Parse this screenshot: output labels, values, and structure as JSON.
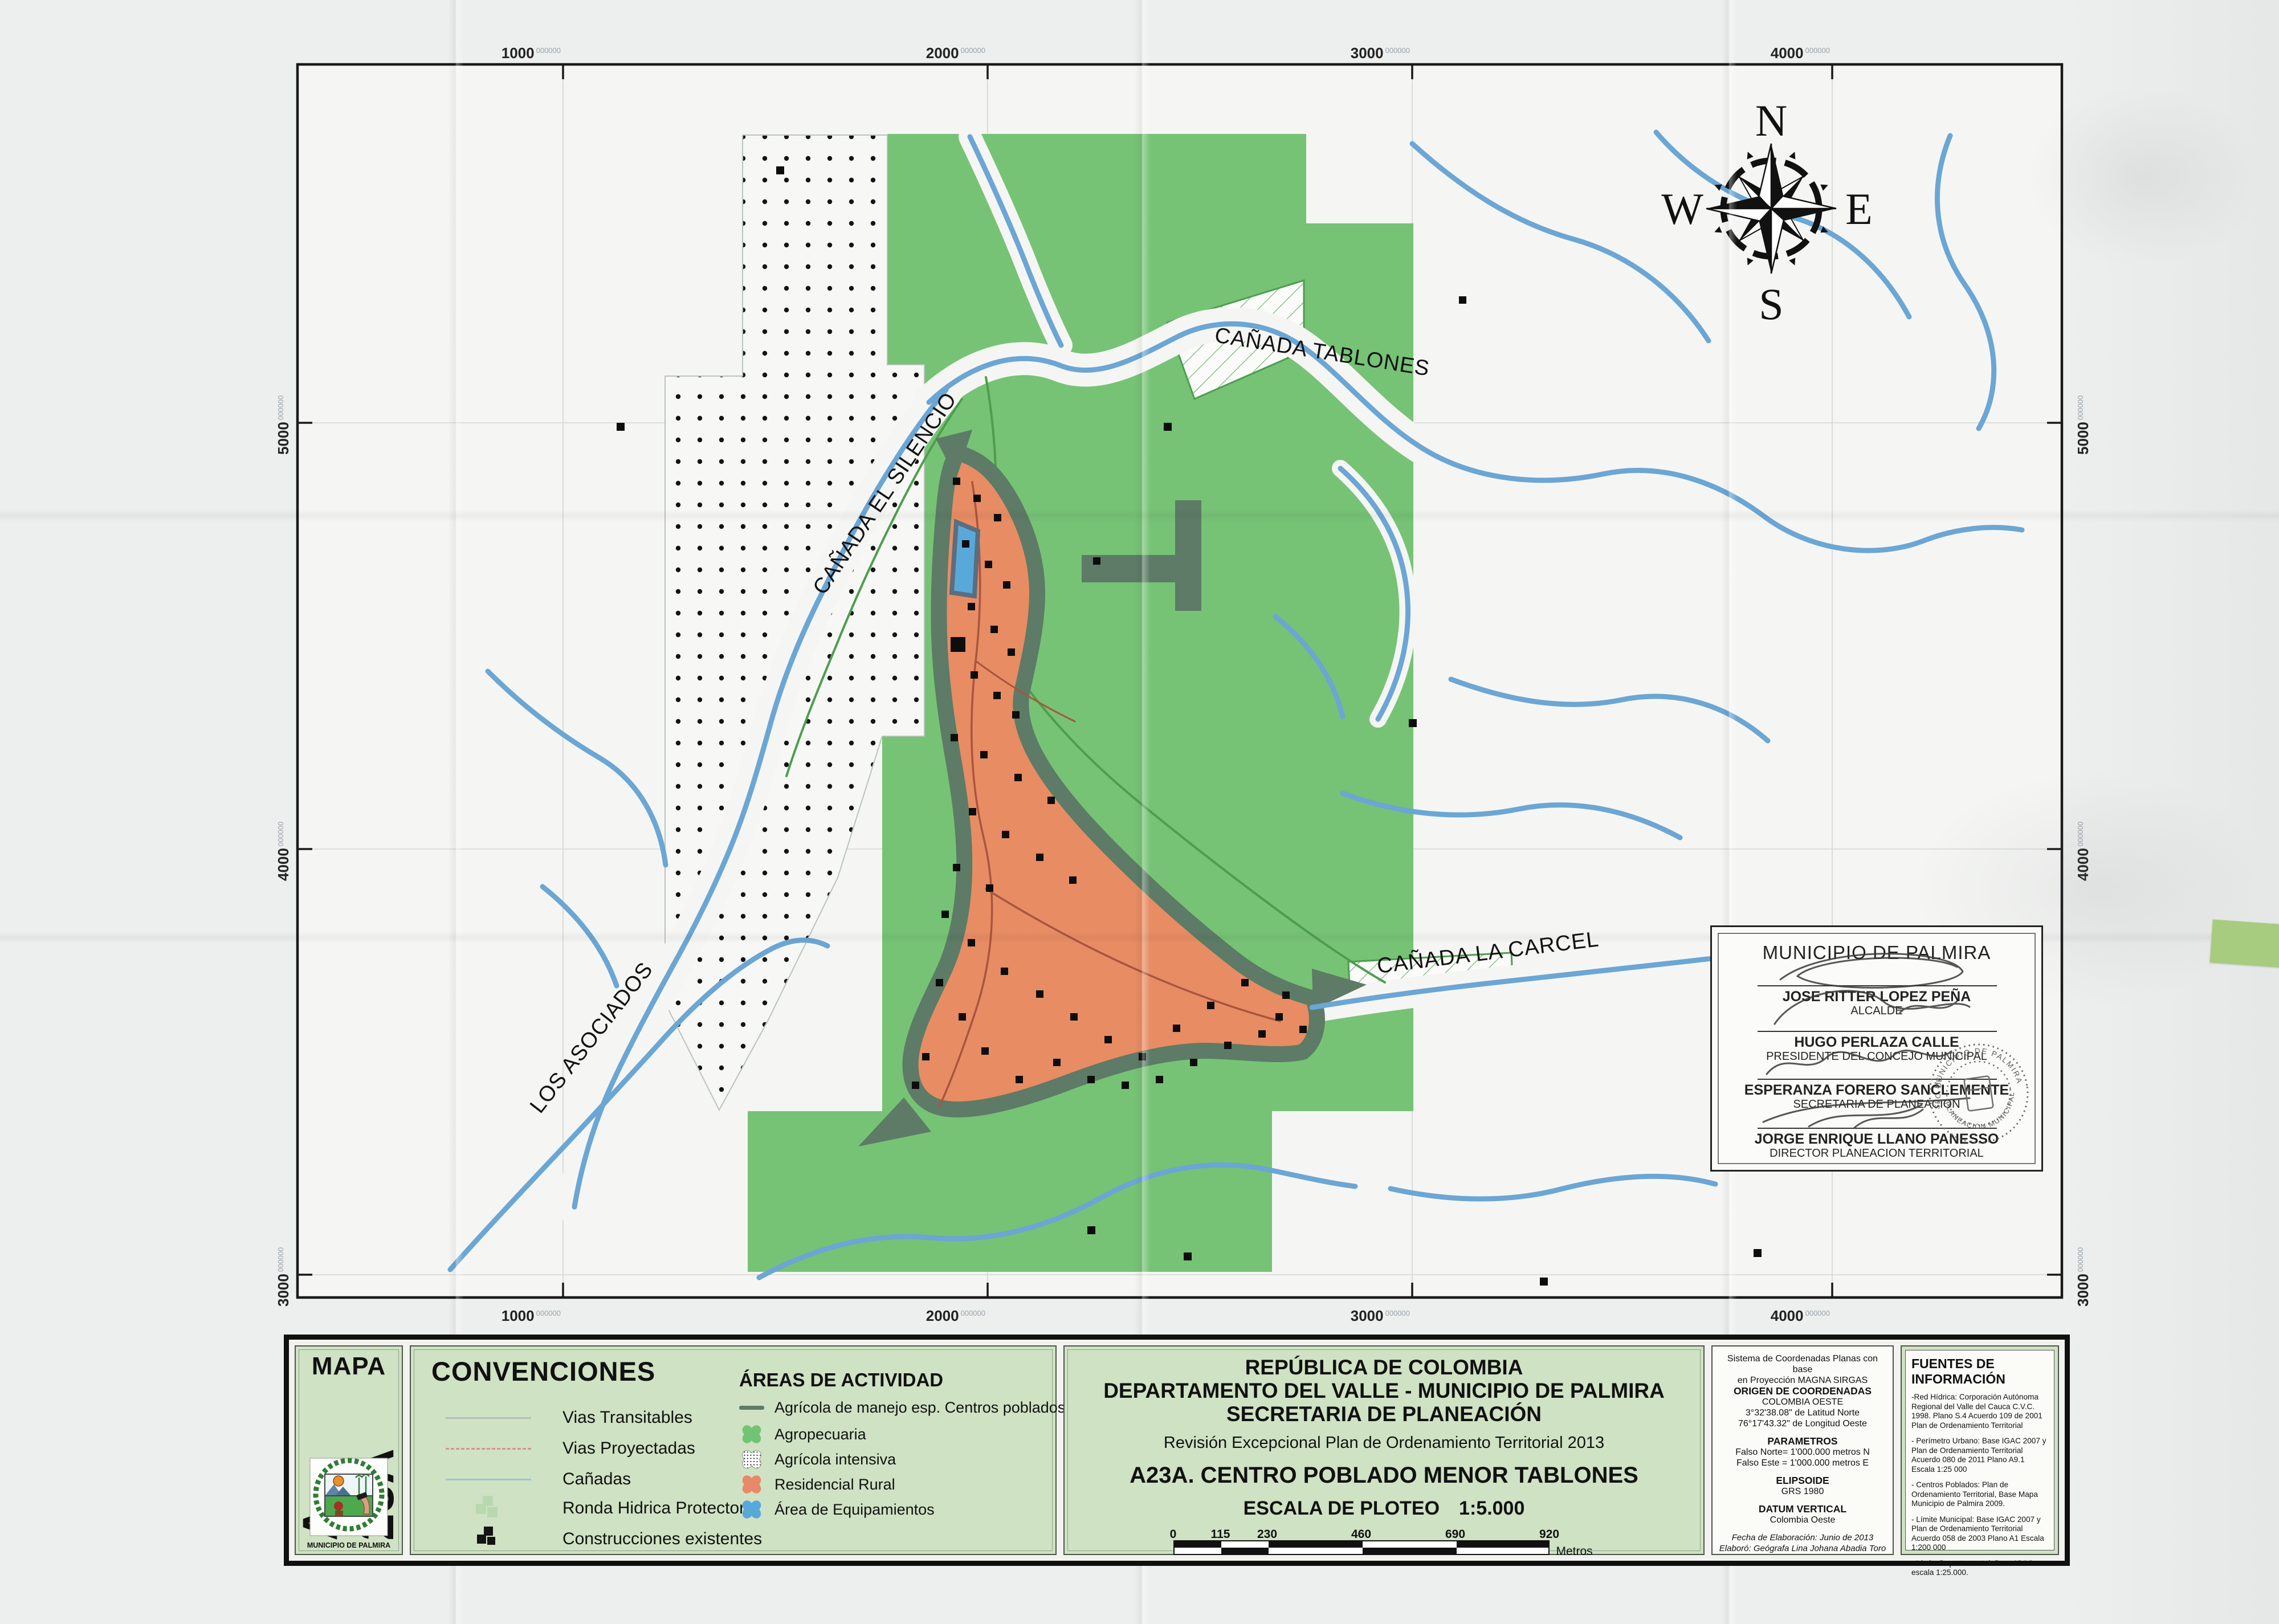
{
  "colors": {
    "paper": "#edefee",
    "map_background": "#f5f6f4",
    "agropecuaria_green": "#76c375",
    "residencial_orange": "#e88c63",
    "ronda_band_sage": "#5d7b66",
    "equipamientos_blue": "#58a9da",
    "river_blue": "#6ba6d4",
    "legend_green": "#cfe2c3",
    "sticky_tab_green": "#a7cc7f",
    "vias_proyectadas_red": "#d99090",
    "vias_transitables_gray": "#b8bdb8"
  },
  "map": {
    "grid": {
      "sup": "000000",
      "top": [
        "1000",
        "2000",
        "3000",
        "4000"
      ],
      "bottom": [
        "1000",
        "2000",
        "3000",
        "4000"
      ],
      "left": [
        "5000",
        "4000",
        "3000"
      ],
      "right": [
        "5000",
        "4000",
        "3000"
      ]
    },
    "labels": {
      "tablones": "CAÑADA TABLONES",
      "silencio": "CAÑADA EL SILENCIO",
      "carcel": "CAÑADA LA CARCEL",
      "asociados": "LOS ASOCIADOS"
    },
    "compass": {
      "n": "N",
      "e": "E",
      "s": "S",
      "w": "W"
    }
  },
  "sig": {
    "title": "MUNICIPIO DE PALMIRA",
    "s1name": "JOSE RITTER LOPEZ PEÑA",
    "s1role": "ALCALDE",
    "s2name": "HUGO PERLAZA CALLE",
    "s2role": "PRESIDENTE DEL CONCEJO MUNICIPAL",
    "s3name": "ESPERANZA FORERO SANCLEMENTE",
    "s3role": "SECRETARIA DE PLANEACION",
    "s4name": "JORGE ENRIQUE LLANO PANESSO",
    "s4role": "DIRECTOR PLANEACION TERRITORIAL",
    "stamp_top": "MUNICIPIO DE PALMIRA",
    "stamp_bottom": "PLANEACION MUNICIPAL",
    "stamp_left": "SEC. DE"
  },
  "panel": {
    "mapa": {
      "word": "MAPA",
      "code": "A-23A",
      "caption": "MUNICIPIO DE PALMIRA"
    },
    "conv": {
      "title": "CONVENCIONES",
      "items": [
        {
          "label": "Vias Transitables"
        },
        {
          "label": "Vias Proyectadas"
        },
        {
          "label": "Cañadas"
        },
        {
          "label": "Ronda Hidrica Protectora"
        },
        {
          "label": "Construcciones existentes"
        }
      ]
    },
    "areas": {
      "title": "ÁREAS DE ACTIVIDAD",
      "items": [
        {
          "label": "Agrícola de manejo esp. Centros poblados"
        },
        {
          "label": "Agropecuaria"
        },
        {
          "label": "Agrícola intensiva"
        },
        {
          "label": "Residencial Rural"
        },
        {
          "label": "Área de Equipamientos"
        }
      ]
    },
    "tb": {
      "l1": "REPÚBLICA DE COLOMBIA",
      "l2": "DEPARTAMENTO DEL VALLE - MUNICIPIO DE PALMIRA",
      "l3": "SECRETARIA DE PLANEACIÓN",
      "sub": "Revisión Excepcional Plan de Ordenamiento Territorial 2013",
      "map_title": "A23A. CENTRO POBLADO MENOR TABLONES",
      "scale_label": "ESCALA DE PLOTEO",
      "scale_value": "1:5.000",
      "ticks": [
        "0",
        "115",
        "230",
        "460",
        "690",
        "920"
      ],
      "unit": "Metros"
    },
    "coords": {
      "c1": "Sistema de Coordenadas Planas con base",
      "c2": "en Proyección MAGNA SIRGAS",
      "c3": "ORIGEN DE COORDENADAS",
      "c4": "COLOMBIA OESTE",
      "c5": "3°32'38.08\" de Latitud Norte",
      "c6": "76°17'43.32\" de Longitud Oeste",
      "params_title": "PARAMETROS",
      "p1": "Falso Norte= 1'000.000 metros N",
      "p2": "Falso Este = 1'000.000 metros E",
      "elip_title": "ELIPSOIDE",
      "elip_value": "GRS 1980",
      "datum_title": "DATUM VERTICAL",
      "datum_value": "Colombia Oeste",
      "date": "Fecha de Elaboración: Junio de 2013",
      "author": "Elaboró: Geógrafa  Lina Johana Abadia Toro"
    },
    "fuentes": {
      "title": "FUENTES DE INFORMACIÓN",
      "p": [
        "-Red Hídrica: Corporación Autónoma Regional del Valle del Cauca C.V.C. 1998. Plano S.4 Acuerdo 109 de 2001 Plan de Ordenamiento Territorial",
        "- Perímetro Urbano: Base IGAC 2007 y Plan de Ordenamiento Territorial Acuerdo 080 de 2011  Plano A9.1  Escala 1:25 000",
        "- Centros Poblados: Plan de Ordenamiento Territorial, Base Mapa Municipio de Palmira 2009.",
        "- Límite Municipal: Base IGAC 2007  y Plan de Ordenamiento Territorial Acuerdo 058 de 2003  Plano A1  Escala 1:200 000",
        "- Límite Departamental: Base IGAC escala 1:25.000."
      ]
    }
  }
}
